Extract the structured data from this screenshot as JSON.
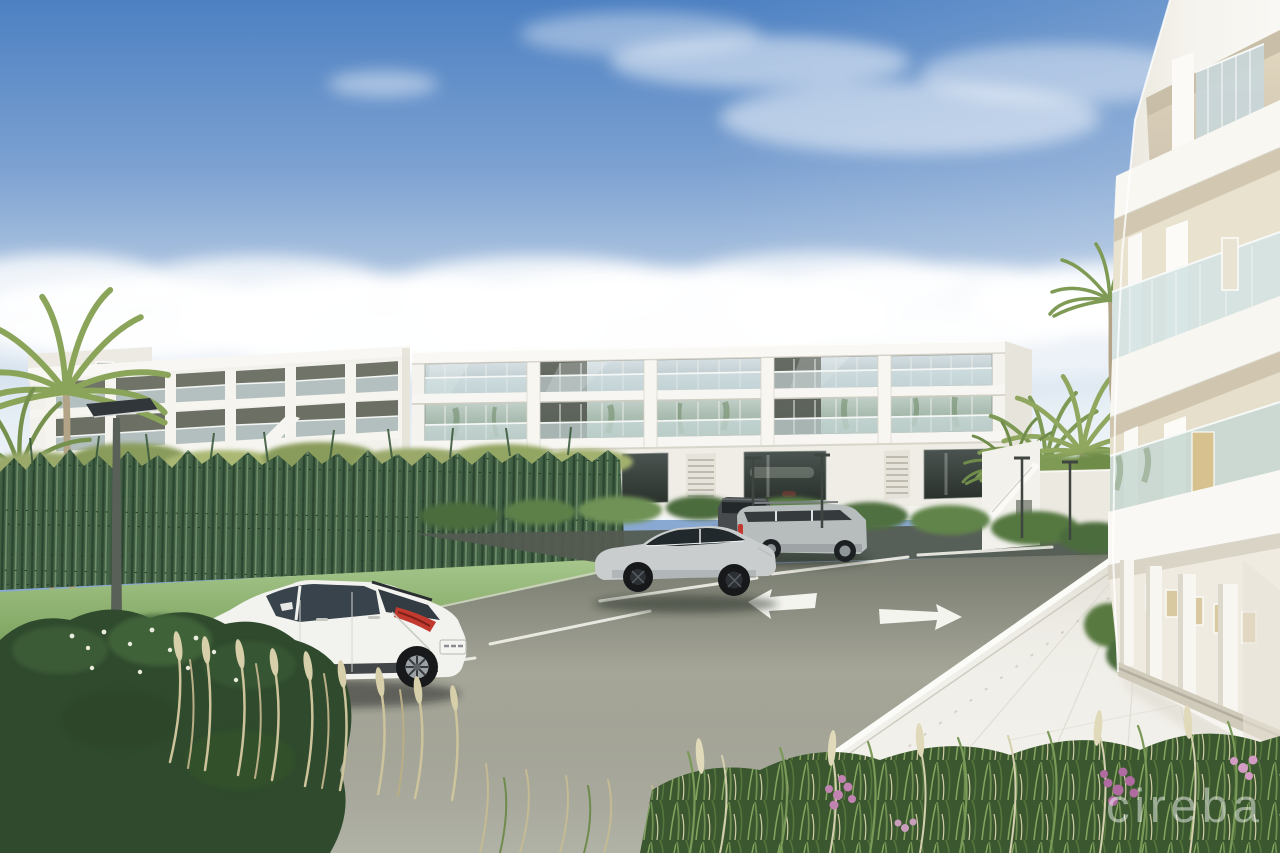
{
  "watermark": {
    "text": "cireba"
  },
  "colors": {
    "sky_top": "#4c80c2",
    "sky_horizon": "#eef3f7",
    "cloud": "#ffffff",
    "facade": "#f4f3ee",
    "facade_shade": "#e7e4db",
    "parapet": "#f9f8f4",
    "glass_sky": "#c9d6d9",
    "glass_palm": "#a7bba8",
    "recess": "#565b52",
    "balustrade": "#d4e2e4",
    "wall": "#eae8e0",
    "reeds": "#3f5e42",
    "lawn": "#85b160",
    "asphalt": "#a5a698",
    "asphalt_dark": "#545b52",
    "marking": "#f4f4ef",
    "walkway": "#f1efe9",
    "curb": "#fbfbf7",
    "taillight": "#c23a2f",
    "bush": "#2f4a2d",
    "grass": "#3a572f",
    "plume": "#d6cfa9",
    "flower_pink": "#c183b2",
    "palm": "#839e58",
    "lamp": "#3f4541",
    "watermark": "#ffffff"
  },
  "vehicles": [
    {
      "type": "white hatchback",
      "color": "#f2f2ef"
    },
    {
      "type": "silver sedan",
      "color": "#c9cdce"
    },
    {
      "type": "silver suv",
      "color": "#b7bcbd"
    },
    {
      "type": "dark suv",
      "color": "#474b4d"
    }
  ],
  "markings": {
    "arrows": [
      "left",
      "right"
    ]
  }
}
